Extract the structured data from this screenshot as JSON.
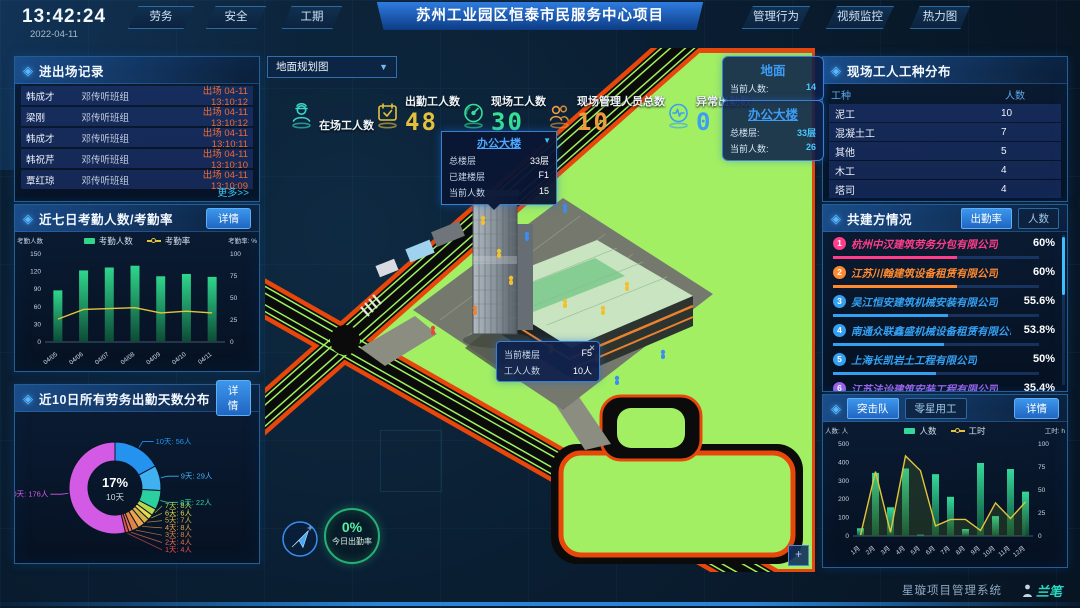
{
  "header": {
    "time": "13:42:24",
    "date": "2022-04-11",
    "left_tabs": [
      {
        "label": "劳务",
        "active": true
      },
      {
        "label": "安全",
        "active": false
      },
      {
        "label": "工期",
        "active": false
      }
    ],
    "title": "苏州工业园区恒泰市民服务中心项目",
    "right_tabs": [
      {
        "label": "管理行为",
        "active": false
      },
      {
        "label": "视频监控",
        "active": false
      },
      {
        "label": "热力图",
        "active": false
      }
    ]
  },
  "entry_exit_panel": {
    "title": "进出场记录",
    "more_label": "更多>>",
    "records": [
      {
        "name": "韩成才",
        "group": "邓传听班组",
        "event": "出场 04-11 13:10:12"
      },
      {
        "name": "梁刚",
        "group": "邓传听班组",
        "event": "出场 04-11 13:10:12"
      },
      {
        "name": "韩成才",
        "group": "邓传听班组",
        "event": "出场 04-11 13:10:11"
      },
      {
        "name": "韩祝芹",
        "group": "邓传听班组",
        "event": "出场 04-11 13:10:10"
      },
      {
        "name": "覃红琼",
        "group": "邓传听班组",
        "event": "出场 04-11 13:10:09"
      }
    ]
  },
  "attendance_panel": {
    "title": "近七日考勤人数/考勤率",
    "detail_label": "详情"
  },
  "distribution_panel": {
    "title": "近10日所有劳务出勤天数分布",
    "detail_label": "详情"
  },
  "map": {
    "view_select": "地面规划图",
    "stats": [
      {
        "label": "在场工人数",
        "value": "",
        "icon": "worker-icon",
        "color": "#38d8c8"
      },
      {
        "label": "出勤工人数",
        "value": "48",
        "icon": "calendar-check-icon",
        "color": "#e3c13e"
      },
      {
        "label": "现场工人数",
        "value": "30",
        "icon": "gauge-icon",
        "color": "#36e096"
      },
      {
        "label": "现场管理人员总数",
        "value": "10",
        "icon": "people-icon",
        "color": "#ee9b3f"
      },
      {
        "label": "异常出勤数",
        "value": "0",
        "icon": "pulse-icon",
        "color": "#3b9ff2"
      }
    ],
    "building_tooltip": {
      "title": "办公大楼",
      "caret": "▼",
      "rows": [
        {
          "label": "总楼层",
          "value": "33层"
        },
        {
          "label": "已建楼层",
          "value": "F1"
        },
        {
          "label": "当前人数",
          "value": "15"
        }
      ]
    },
    "floor_tooltip": {
      "close": "×",
      "rows": [
        {
          "label": "当前楼层",
          "value": "F5"
        },
        {
          "label": "工人人数",
          "value": "10人"
        }
      ]
    },
    "floor_cards": [
      {
        "title": "地面",
        "clickable": false,
        "rows": [
          {
            "label": "当前人数:",
            "value": "14"
          }
        ]
      },
      {
        "title": "办公大楼",
        "clickable": true,
        "rows": [
          {
            "label": "总楼层:",
            "value": "33层"
          },
          {
            "label": "当前人数:",
            "value": "26"
          }
        ]
      }
    ],
    "attendance_rate": {
      "value": "0%",
      "label": "今日出勤率"
    }
  },
  "worker_type_panel": {
    "title": "现场工人工种分布",
    "headers": [
      "工种",
      "人数"
    ],
    "rows": [
      {
        "type": "泥工",
        "count": "10"
      },
      {
        "type": "混凝土工",
        "count": "7"
      },
      {
        "type": "其他",
        "count": "5"
      },
      {
        "type": "木工",
        "count": "4"
      },
      {
        "type": "塔司",
        "count": "4"
      }
    ]
  },
  "partners_panel": {
    "title": "共建方情况",
    "tabs": [
      {
        "label": "出勤率",
        "active": true
      },
      {
        "label": "人数",
        "active": false
      }
    ],
    "items": [
      {
        "rank": "1",
        "name": "杭州中汉建筑劳务分包有限公司",
        "value": "60%",
        "pct": 60,
        "color": "#ff3d88"
      },
      {
        "rank": "2",
        "name": "江苏川翰建筑设备租赁有限公司",
        "value": "60%",
        "pct": 60,
        "color": "#ff8a2e"
      },
      {
        "rank": "3",
        "name": "吴江恒安建筑机械安装有限公司",
        "value": "55.6%",
        "pct": 55.6,
        "color": "#33a0f2"
      },
      {
        "rank": "4",
        "name": "南通众联鑫盛机械设备租赁有限公司",
        "value": "53.8%",
        "pct": 53.8,
        "color": "#33a0f2"
      },
      {
        "rank": "5",
        "name": "上海长凯岩土工程有限公司",
        "value": "50%",
        "pct": 50,
        "color": "#33a0f2"
      },
      {
        "rank": "6",
        "name": "江苏法诒建筑安装工程有限公司",
        "value": "35.4%",
        "pct": 35.4,
        "color": "#9a63ea"
      }
    ]
  },
  "squad_panel": {
    "tabs": [
      {
        "label": "突击队",
        "active": true
      },
      {
        "label": "零星用工",
        "active": false
      }
    ],
    "detail_label": "详情"
  },
  "footer": {
    "system_name": "星璇项目管理系统",
    "logo_text": "兰笔"
  },
  "chart_data": [
    {
      "id": "attendance",
      "type": "bar-line",
      "categories": [
        "04/05",
        "04/06",
        "04/07",
        "04/08",
        "04/09",
        "04/10",
        "04/11"
      ],
      "series": [
        {
          "name": "考勤人数",
          "type": "bar",
          "color": "#2fd68c",
          "values": [
            88,
            122,
            127,
            130,
            112,
            116,
            111
          ]
        },
        {
          "name": "考勤率",
          "type": "line",
          "color": "#e2c53c",
          "values": [
            26,
            37,
            38,
            39,
            33,
            35,
            33
          ]
        }
      ],
      "left_axis": {
        "label": "考勤人数",
        "max": 150,
        "ticks": [
          0,
          30,
          60,
          90,
          120,
          150
        ]
      },
      "right_axis": {
        "label": "考勤率: %",
        "max": 100,
        "ticks": [
          0,
          25,
          50,
          75,
          100
        ]
      },
      "area": false
    },
    {
      "id": "distribution",
      "type": "donut",
      "center": {
        "value": "17%",
        "label": "10天"
      },
      "slices": [
        {
          "label": "10天",
          "count": "56人",
          "value": 56,
          "color": "#2492ef"
        },
        {
          "label": "9天",
          "count": "29人",
          "value": 29,
          "color": "#3fb0f0"
        },
        {
          "label": "8天",
          "count": "22人",
          "value": 22,
          "color": "#2bd0a0"
        },
        {
          "label": "7天",
          "count": "8人",
          "value": 8,
          "color": "#b8d84e"
        },
        {
          "label": "6天",
          "count": "6人",
          "value": 6,
          "color": "#e6da4a"
        },
        {
          "label": "5天",
          "count": "7人",
          "value": 7,
          "color": "#d9b246"
        },
        {
          "label": "4天",
          "count": "8人",
          "value": 8,
          "color": "#eda34c"
        },
        {
          "label": "3天",
          "count": "8人",
          "value": 8,
          "color": "#dd8446"
        },
        {
          "label": "2天",
          "count": "4人",
          "value": 4,
          "color": "#ef7050"
        },
        {
          "label": "1天",
          "count": "4人",
          "value": 4,
          "color": "#ec4f4f"
        },
        {
          "label": "0天",
          "count": "176人",
          "value": 176,
          "color": "#d35ae4"
        }
      ]
    },
    {
      "id": "monthly",
      "type": "bar-line",
      "categories": [
        "1月",
        "2月",
        "3月",
        "4月",
        "5月",
        "6月",
        "7月",
        "8月",
        "9月",
        "10月",
        "11月",
        "12月"
      ],
      "series": [
        {
          "name": "人数",
          "type": "bar",
          "color": "#35d89a",
          "values": [
            42,
            343,
            156,
            367,
            7,
            336,
            213,
            38,
            397,
            108,
            364,
            241
          ]
        },
        {
          "name": "工时",
          "type": "line",
          "color": "#e2c53c",
          "values": [
            1,
            70,
            4,
            87,
            71,
            11,
            18,
            18,
            6,
            36,
            19,
            37
          ]
        }
      ],
      "left_axis": {
        "label": "人数: 人",
        "max": 500,
        "ticks": [
          0,
          100,
          200,
          300,
          400,
          500
        ]
      },
      "right_axis": {
        "label": "工时: h",
        "max": 100,
        "ticks": [
          0,
          25,
          50,
          75,
          100
        ]
      },
      "area": true
    }
  ]
}
